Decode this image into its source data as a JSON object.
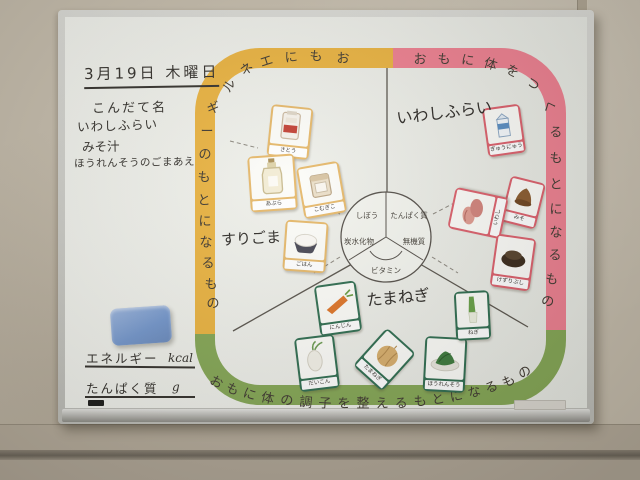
{
  "photo": {
    "board": {
      "notes": {
        "date": "3月19日 木曜日",
        "menu_title": "こんだて名",
        "menu_items": [
          "いわしふらい",
          "みそ汁",
          "ほうれんそうのごまあえ"
        ]
      },
      "footer": {
        "energy_label": "エネルギー",
        "energy_unit": "kcal",
        "protein_label": "たんぱく質",
        "protein_unit": "g"
      }
    },
    "chart": {
      "arcs": [
        {
          "name": "energy",
          "label": "おもにエネルギーのもとになるもの",
          "color": "#eab340"
        },
        {
          "name": "body",
          "label": "おもに体をつくるもとになるもの",
          "color": "#ee8090"
        },
        {
          "name": "regulate",
          "label": "おもに体の調子を整えるもとになるもの",
          "color": "#85a755"
        }
      ],
      "center_labels": [
        "しぼう",
        "たんぱく質",
        "炭水化物",
        "無機質",
        "ビタミン"
      ],
      "card_colors": {
        "energy": "#e6b869",
        "body": "#dc5f6b",
        "regulate": "#2f6d50"
      },
      "cards": [
        {
          "group": "energy",
          "label": "さとう",
          "art": "sugar",
          "x": 288,
          "y": 130,
          "w": 38,
          "h": 48,
          "rot": 6
        },
        {
          "group": "energy",
          "label": "あぶら",
          "art": "oil",
          "x": 270,
          "y": 181,
          "w": 43,
          "h": 52,
          "rot": -4
        },
        {
          "group": "energy",
          "label": "こむぎこ",
          "art": "flour",
          "x": 319,
          "y": 188,
          "w": 39,
          "h": 48,
          "rot": -10
        },
        {
          "group": "energy",
          "label": "ごはん",
          "art": "rice",
          "x": 303,
          "y": 244,
          "w": 39,
          "h": 47,
          "rot": 4
        },
        {
          "group": "body",
          "label": "ぎゅうにゅう",
          "art": "milk",
          "x": 502,
          "y": 128,
          "w": 34,
          "h": 45,
          "rot": -8
        },
        {
          "group": "body",
          "label": "みそ",
          "art": "miso",
          "x": 521,
          "y": 200,
          "w": 32,
          "h": 43,
          "rot": 14
        },
        {
          "group": "body",
          "label": "いわし",
          "art": "sardine",
          "x": 476,
          "y": 211,
          "w": 38,
          "h": 50,
          "rot": -78
        },
        {
          "group": "body",
          "label": "けずりぶし",
          "art": "bonito",
          "x": 511,
          "y": 260,
          "w": 36,
          "h": 49,
          "rot": 8
        },
        {
          "group": "regulate",
          "label": "にんじん",
          "art": "carrot",
          "x": 336,
          "y": 306,
          "w": 38,
          "h": 47,
          "rot": -8
        },
        {
          "group": "regulate",
          "label": "だいこん",
          "art": "radish",
          "x": 315,
          "y": 361,
          "w": 36,
          "h": 50,
          "rot": -7
        },
        {
          "group": "regulate",
          "label": "たまねぎ",
          "art": "onion",
          "x": 382,
          "y": 357,
          "w": 35,
          "h": 47,
          "rot": 42
        },
        {
          "group": "regulate",
          "label": "ほうれんそう",
          "art": "spinach",
          "x": 443,
          "y": 362,
          "w": 38,
          "h": 51,
          "rot": 3
        },
        {
          "group": "regulate",
          "label": "ねぎ",
          "art": "leek",
          "x": 470,
          "y": 313,
          "w": 31,
          "h": 45,
          "rot": -3
        }
      ],
      "annotations": [
        {
          "text": "いわしふらい",
          "x": 444,
          "y": 111,
          "size": 16,
          "rot": -7
        },
        {
          "text": "すりごま",
          "x": 251,
          "y": 238,
          "size": 15,
          "rot": -3
        },
        {
          "text": "たまねぎ",
          "x": 398,
          "y": 296,
          "size": 16,
          "rot": -5
        }
      ]
    },
    "objects": {
      "eraser_color": "#7d9fcf"
    }
  }
}
